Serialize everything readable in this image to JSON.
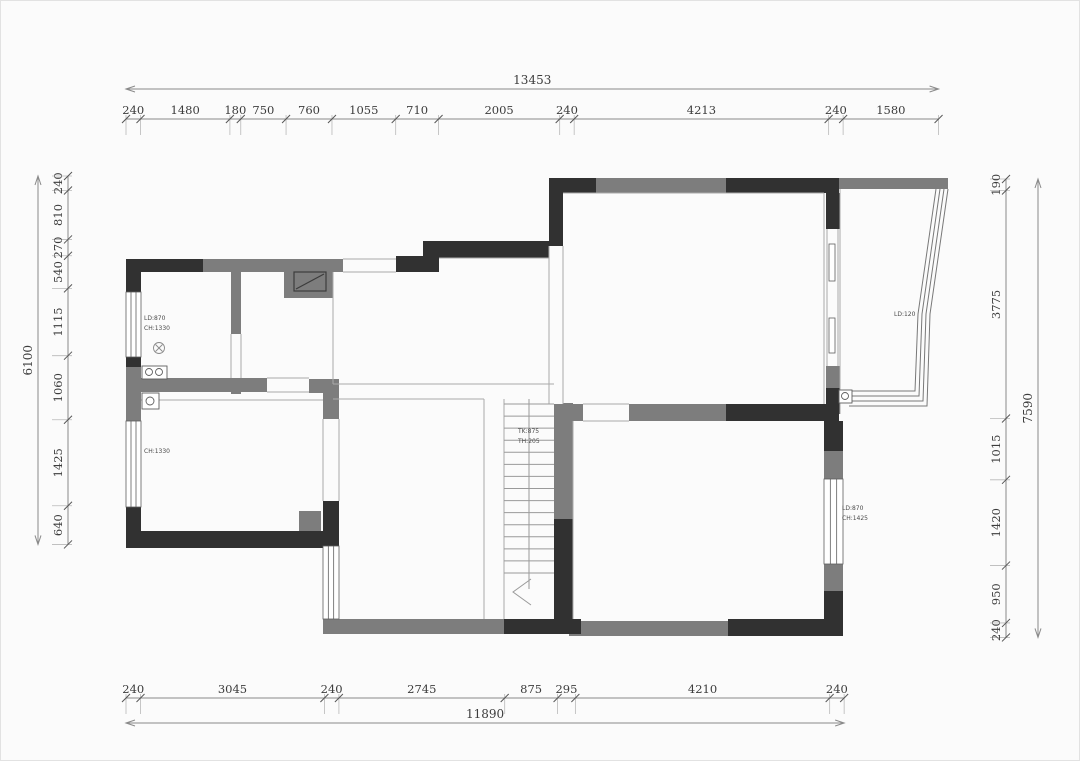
{
  "meta": {
    "drawing_type": "residential floor plan with dimension chains"
  },
  "colors": {
    "background": "#fbfbfb",
    "wall_dark": "#313131",
    "wall_gray": "#7d7d7d",
    "thin_line": "#aaaaaa",
    "dim_line": "#8a8a8a",
    "ext_line": "#b8b8b8",
    "tick": "#555555",
    "glass_line": "#787878",
    "fixture_line": "#5f5f5f",
    "stair_line": "#9a9a9a"
  },
  "drawing": {
    "walls_dark": [
      [
        125,
        258,
        77,
        13
      ],
      [
        125,
        258,
        15,
        33
      ],
      [
        125,
        356,
        15,
        10
      ],
      [
        125,
        506,
        15,
        41
      ],
      [
        125,
        530,
        212,
        17
      ],
      [
        322,
        500,
        16,
        45
      ],
      [
        395,
        255,
        43,
        16
      ],
      [
        422,
        240,
        136,
        17
      ],
      [
        548,
        177,
        14,
        68
      ],
      [
        548,
        177,
        47,
        15
      ],
      [
        725,
        177,
        113,
        15
      ],
      [
        825,
        192,
        14,
        36
      ],
      [
        825,
        387,
        14,
        26
      ],
      [
        725,
        403,
        113,
        17
      ],
      [
        553,
        518,
        19,
        115
      ],
      [
        503,
        618,
        77,
        15
      ],
      [
        727,
        618,
        115,
        17
      ],
      [
        823,
        420,
        19,
        30
      ],
      [
        823,
        590,
        19,
        45
      ]
    ],
    "walls_gray": [
      [
        202,
        258,
        140,
        13
      ],
      [
        283,
        271,
        49,
        26
      ],
      [
        125,
        366,
        15,
        54
      ],
      [
        230,
        271,
        10,
        62
      ],
      [
        125,
        377,
        141,
        14
      ],
      [
        308,
        378,
        30,
        14
      ],
      [
        322,
        390,
        16,
        28
      ],
      [
        298,
        510,
        22,
        20
      ],
      [
        595,
        177,
        130,
        15
      ],
      [
        838,
        177,
        109,
        11
      ],
      [
        825,
        210,
        14,
        18
      ],
      [
        825,
        365,
        14,
        22
      ],
      [
        553,
        402,
        19,
        116
      ],
      [
        555,
        403,
        27,
        17
      ],
      [
        628,
        403,
        97,
        17
      ],
      [
        322,
        618,
        181,
        15
      ],
      [
        568,
        620,
        159,
        15
      ],
      [
        823,
        450,
        19,
        28
      ],
      [
        823,
        563,
        19,
        27
      ],
      [
        230,
        377,
        10,
        16
      ]
    ],
    "openings": [
      {
        "r": [
          342,
          258,
          53,
          13
        ],
        "dir": "h"
      },
      {
        "r": [
          582,
          403,
          46,
          17
        ],
        "dir": "h"
      },
      {
        "r": [
          548,
          245,
          14,
          158
        ],
        "dir": "v"
      },
      {
        "r": [
          266,
          377,
          42,
          14
        ],
        "dir": "h"
      },
      {
        "r": [
          230,
          333,
          10,
          44
        ],
        "dir": "v"
      },
      {
        "r": [
          322,
          418,
          16,
          82
        ],
        "dir": "v"
      }
    ],
    "windows": [
      {
        "r": [
          125,
          291,
          15,
          65
        ],
        "dir": "v"
      },
      {
        "r": [
          125,
          420,
          15,
          86
        ],
        "dir": "v"
      },
      {
        "r": [
          322,
          545,
          16,
          73
        ],
        "dir": "v"
      },
      {
        "r": [
          823,
          478,
          19,
          85
        ],
        "dir": "v"
      }
    ],
    "thin_lines": [
      [
        332,
        271,
        332,
        383
      ],
      [
        332,
        383,
        553,
        383
      ],
      [
        332,
        398,
        483,
        398
      ],
      [
        483,
        398,
        483,
        618
      ],
      [
        503,
        398,
        503,
        618
      ],
      [
        562,
        192,
        823,
        192
      ],
      [
        823,
        192,
        823,
        403
      ],
      [
        140,
        399,
        322,
        399
      ],
      [
        839,
        188,
        839,
        413
      ],
      [
        438,
        257,
        548,
        257
      ],
      [
        572,
        420,
        572,
        618
      ]
    ],
    "glass_polylines": [
      [
        [
          935,
          188
        ],
        [
          917,
          313
        ],
        [
          914,
          390
        ],
        [
          848,
          390
        ]
      ],
      [
        [
          939,
          188
        ],
        [
          921,
          313
        ],
        [
          918,
          395
        ],
        [
          848,
          395
        ]
      ],
      [
        [
          943,
          188
        ],
        [
          925,
          313
        ],
        [
          922,
          400
        ],
        [
          848,
          400
        ]
      ],
      [
        [
          947,
          188
        ],
        [
          929,
          313
        ],
        [
          926,
          405
        ],
        [
          848,
          405
        ]
      ]
    ],
    "stairs": {
      "x1": 503,
      "x2": 553,
      "tread_y_start": 403,
      "tread_y_end": 572,
      "treads": 15,
      "center_line": [
        528,
        398,
        528,
        588
      ],
      "arrow": [
        [
          530,
          578
        ],
        [
          512,
          591
        ],
        [
          530,
          604
        ]
      ]
    },
    "sliding_door": {
      "track_lines": [
        [
          826,
          228,
          826,
          365
        ],
        [
          837,
          228,
          837,
          365
        ]
      ],
      "panels": [
        [
          828,
          243,
          6,
          37
        ],
        [
          828,
          317,
          6,
          35
        ]
      ]
    },
    "fixtures": {
      "niche": {
        "rect": [
          293,
          271,
          32,
          19
        ],
        "diag": [
          295,
          288,
          323,
          273
        ]
      },
      "ceiling_symbol": {
        "cx": 158,
        "cy": 347,
        "r": 5.5
      },
      "sink": {
        "rect": [
          141,
          365,
          25,
          13
        ],
        "circles": [
          [
            148,
            371,
            3.5
          ],
          [
            158,
            371,
            3.5
          ]
        ]
      },
      "corner_box": {
        "rect": [
          141,
          392,
          17,
          16
        ],
        "circles": [
          [
            149,
            400,
            4
          ]
        ]
      },
      "balcony_box": {
        "rect": [
          838,
          389,
          13,
          13
        ],
        "circles": [
          [
            844,
            395,
            3.5
          ]
        ]
      }
    },
    "room_labels": [
      {
        "x": 143,
        "y": 319,
        "lines": [
          "LD:870",
          "CH:1330"
        ]
      },
      {
        "x": 143,
        "y": 452,
        "lines": [
          "CH:1330"
        ]
      },
      {
        "x": 517,
        "y": 432,
        "lines": [
          "TK:875",
          "TH:205"
        ]
      },
      {
        "x": 893,
        "y": 315,
        "lines": [
          "LD:120"
        ]
      },
      {
        "x": 841,
        "y": 509,
        "lines": [
          "LD:870",
          "CH:1425"
        ]
      }
    ]
  },
  "dimensions": {
    "scale_px_per_mm": 0.0604,
    "top": {
      "orientation": "h",
      "origin": 125,
      "line": 118,
      "total_line": 88,
      "total": "13453",
      "segments": [
        240,
        1480,
        180,
        750,
        760,
        1055,
        710,
        2005,
        240,
        4213,
        240,
        1580
      ]
    },
    "bottom": {
      "orientation": "h",
      "origin": 125,
      "line": 697,
      "total_line": 722,
      "total": "11890",
      "segments": [
        240,
        3045,
        240,
        2745,
        875,
        295,
        4210,
        240
      ]
    },
    "left": {
      "orientation": "v",
      "origin": 175,
      "line": 67,
      "total_line": 37,
      "total": "6100",
      "segments": [
        240,
        810,
        270,
        540,
        1115,
        1060,
        1425,
        640
      ]
    },
    "right": {
      "orientation": "v",
      "origin": 178,
      "line": 1005,
      "total_line": 1037,
      "total": "7590",
      "segments": [
        190,
        3775,
        1015,
        1420,
        950,
        240
      ]
    }
  }
}
